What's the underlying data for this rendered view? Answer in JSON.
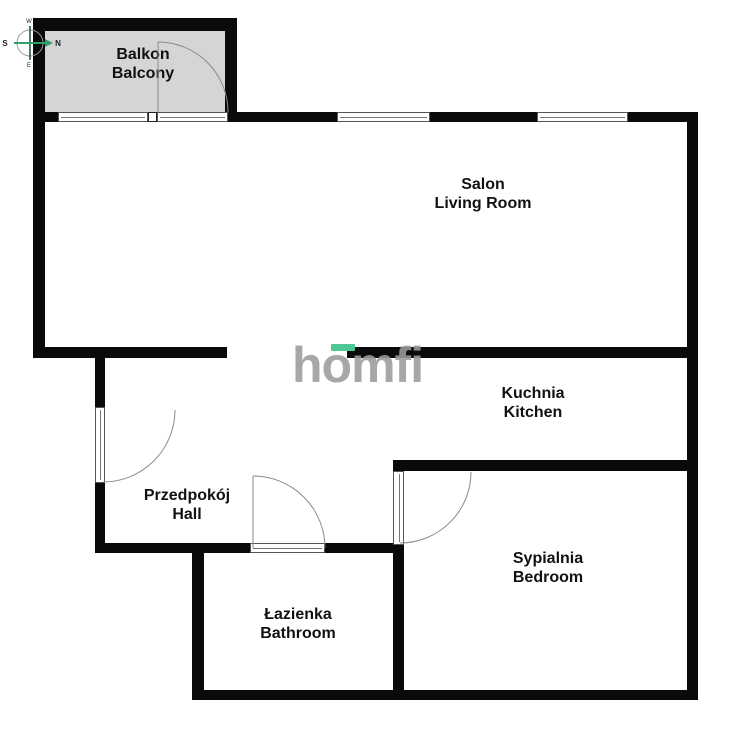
{
  "title": "Apartment floor plan",
  "watermark": {
    "text": "homfi"
  },
  "compass": {
    "n": "N",
    "s": "S",
    "w": "W",
    "e": "E"
  },
  "rooms": {
    "balcony": {
      "pl": "Balkon",
      "en": "Balcony"
    },
    "living": {
      "pl": "Salon",
      "en": "Living Room"
    },
    "kitchen": {
      "pl": "Kuchnia",
      "en": "Kitchen"
    },
    "hall": {
      "pl": "Przedpokój",
      "en": "Hall"
    },
    "bathroom": {
      "pl": "Łazienka",
      "en": "Bathroom"
    },
    "bedroom": {
      "pl": "Sypialnia",
      "en": "Bedroom"
    }
  },
  "colors": {
    "background": "#ffffff",
    "wall": "#0a0a0a",
    "balcony_fill": "#d5d5d5",
    "logo_gray": "#9b9b9b",
    "logo_green": "#4fc795",
    "compass_green": "#2f9e68",
    "compass_dark": "#1c4d33",
    "door_arc": "#8a8a8a",
    "label_text": "#111111"
  }
}
